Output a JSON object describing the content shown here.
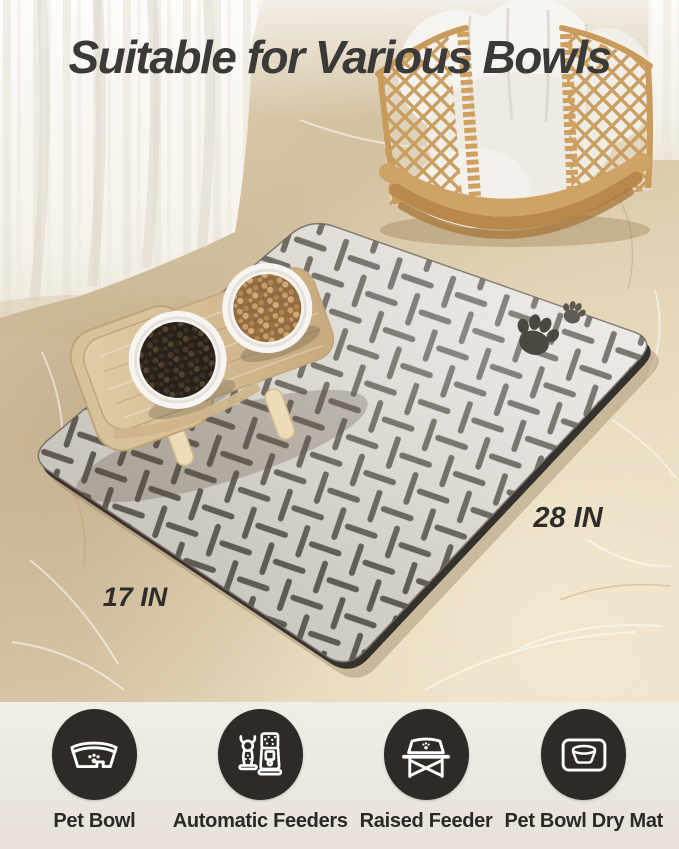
{
  "title": {
    "text": "Suitable for Various Bowls"
  },
  "mat": {
    "length_label": "28 IN",
    "width_label": "17 IN"
  },
  "features": [
    {
      "icon": "pet-bowl-icon",
      "label": "Pet Bowl"
    },
    {
      "icon": "automatic-feeder-icon",
      "label": "Automatic Feeders"
    },
    {
      "icon": "raised-feeder-icon",
      "label": "Raised Feeder"
    },
    {
      "icon": "pet-bowl-dry-mat-icon",
      "label": "Pet Bowl Dry Mat"
    }
  ],
  "colors": {
    "title-color": "#3b3a38",
    "dimension-color": "#2f2d2b",
    "feature-label-color": "#2b2926",
    "badge-bg": "#2e2b27",
    "badge-icon": "#ffffff",
    "footer-bg": "#ece7e0",
    "mat-fill": "#d9d5cf",
    "mat-pattern": "#57514a",
    "floor-beige": "#d8c8a9",
    "wood": "#d5bf9a",
    "rattan": "#c89b5c",
    "kibble-dark": "#28211a",
    "kibble-light": "#8f6b42"
  }
}
